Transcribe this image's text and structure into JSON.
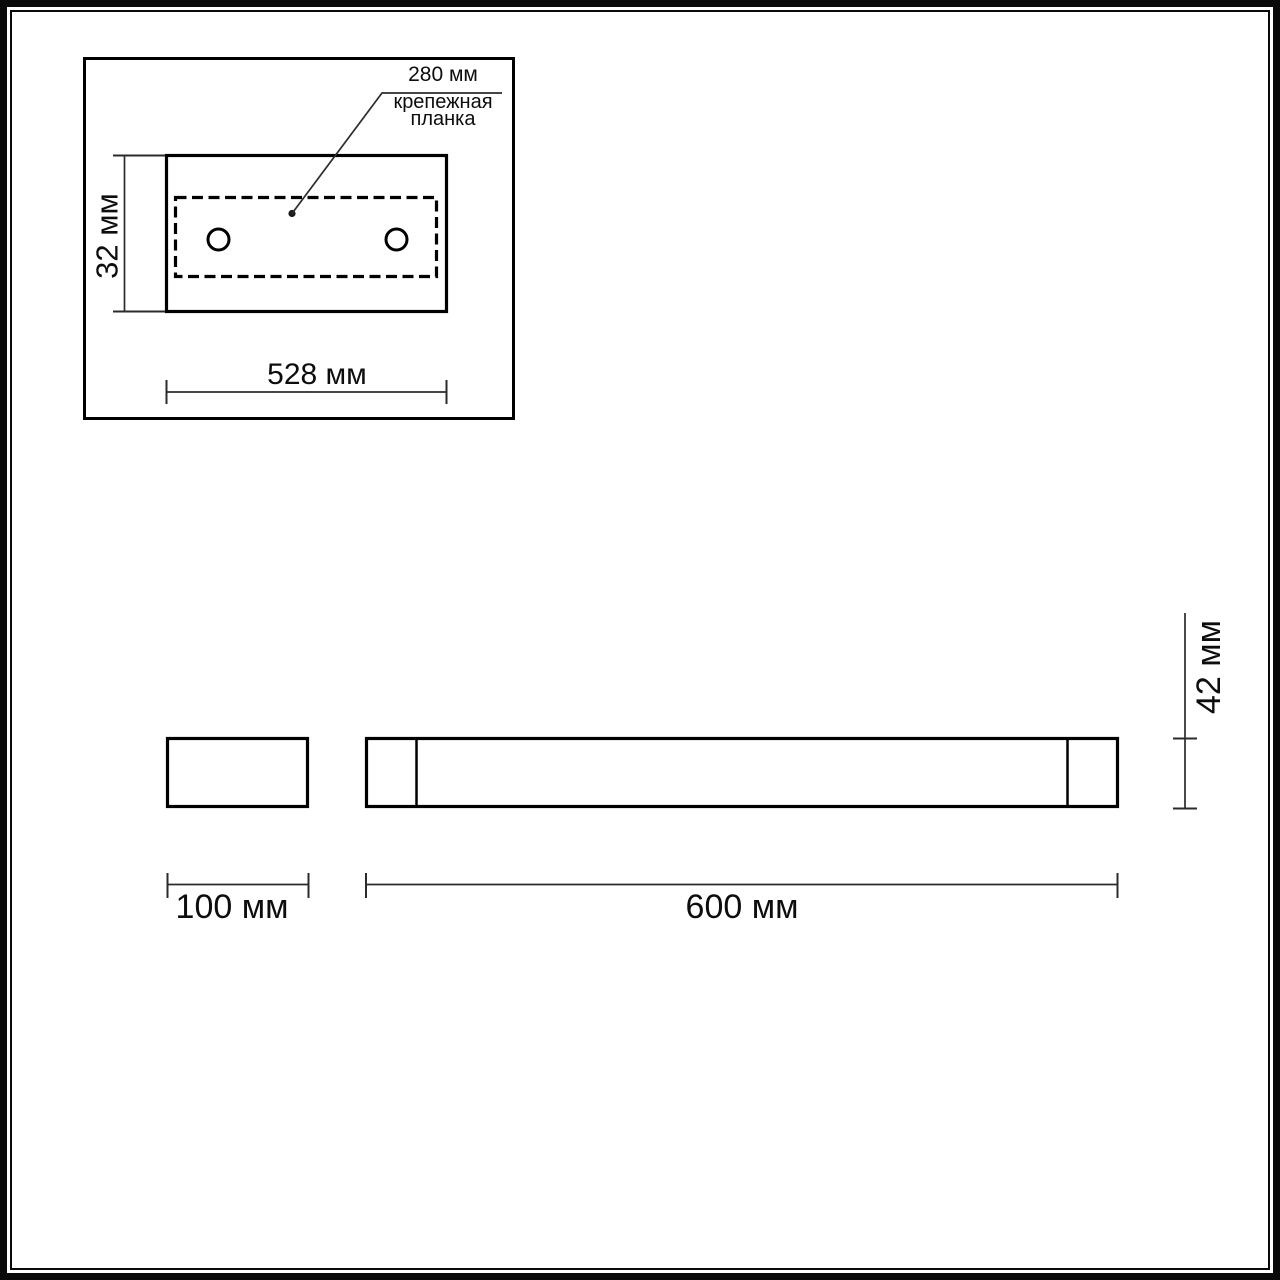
{
  "page": {
    "background": "#ffffff",
    "outline_color": "#000000",
    "dim_line_color": "#2b2b2b"
  },
  "inset": {
    "callout_value": "280 мм",
    "callout_label_line1": "крепежная",
    "callout_label_line2": "планка",
    "height_dim": "32 мм",
    "width_dim": "528 мм"
  },
  "profile": {
    "side_width_dim": "100 мм",
    "front_width_dim": "600 мм",
    "front_height_dim": "42 мм"
  }
}
